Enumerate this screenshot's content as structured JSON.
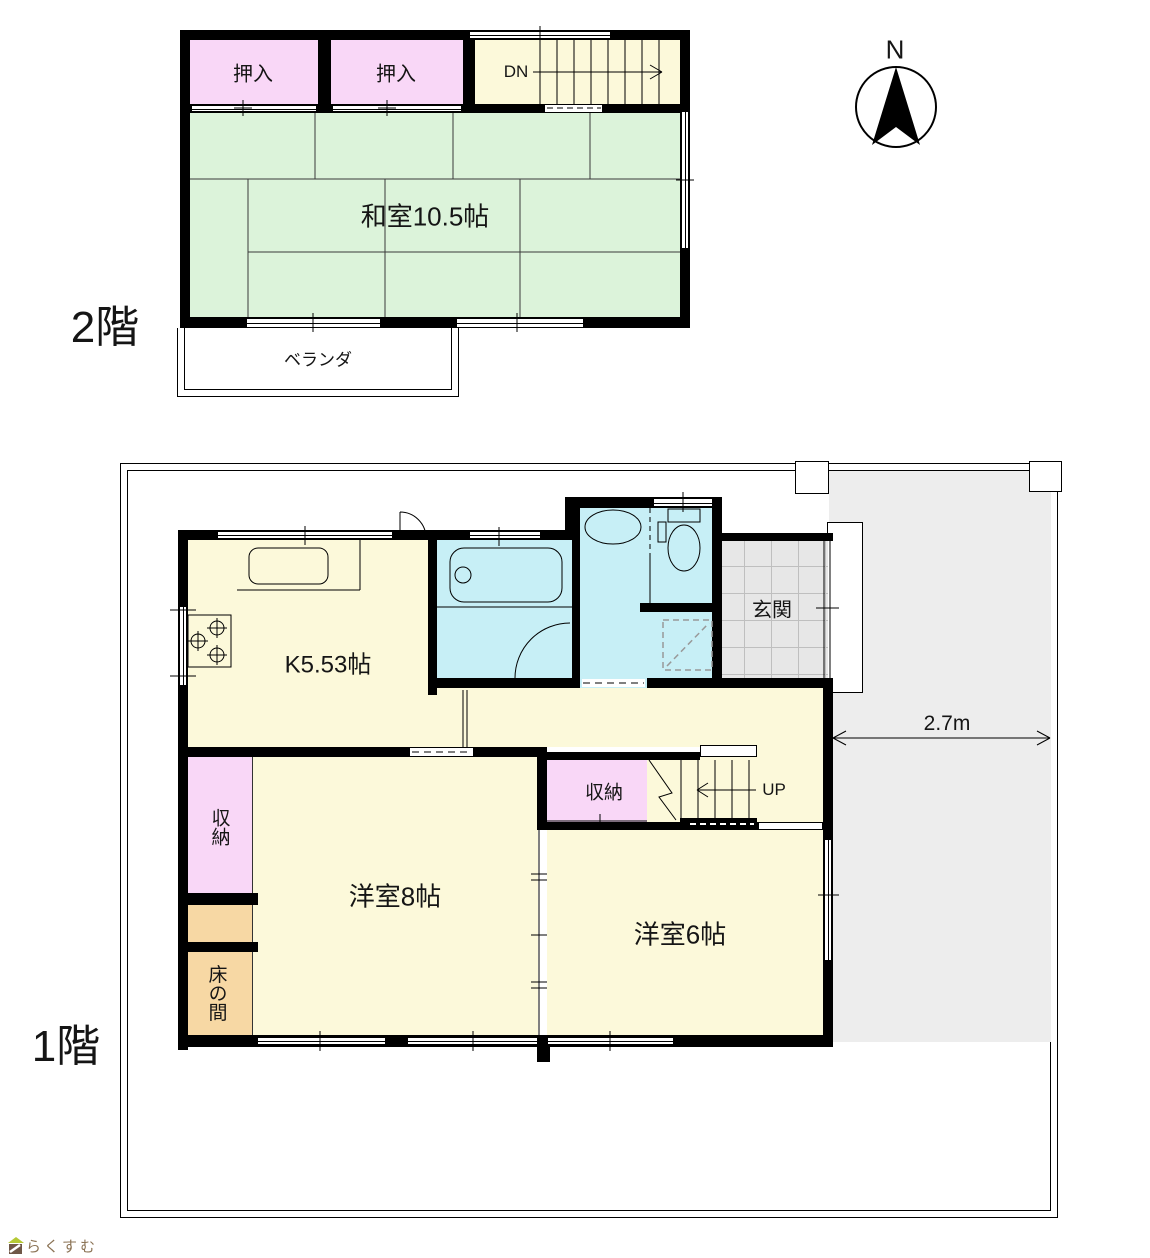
{
  "meta": {
    "floor2_label": "2階",
    "floor1_label": "1階",
    "compass_north": "N",
    "logo_text": "らくすむ"
  },
  "floor2": {
    "closet_a": "押入",
    "closet_b": "押入",
    "stairs_down": "DN",
    "tatami_room": "和室10.5帖",
    "veranda": "ベランダ"
  },
  "floor1": {
    "kitchen": "K5.53帖",
    "entrance": "玄関",
    "hall_closet": "収納",
    "west_closet": "収納",
    "stairs_up": "UP",
    "western_room_8": "洋室8帖",
    "western_room_6": "洋室6帖",
    "tokonoma": "床の間",
    "driveway_width": "2.7m"
  },
  "colors": {
    "wall": "#000000",
    "tatami_green": "#dcf3da",
    "closet_pink": "#f9d7f7",
    "floor_yellow": "#fcf9da",
    "water_cyan": "#c7eff6",
    "tokonoma_orange": "#f7d8a4",
    "entrance_tile": "#e7e7e7",
    "driveway_gray": "#ededed",
    "logo_brown": "#8b7355",
    "logo_green": "#b5c934"
  }
}
